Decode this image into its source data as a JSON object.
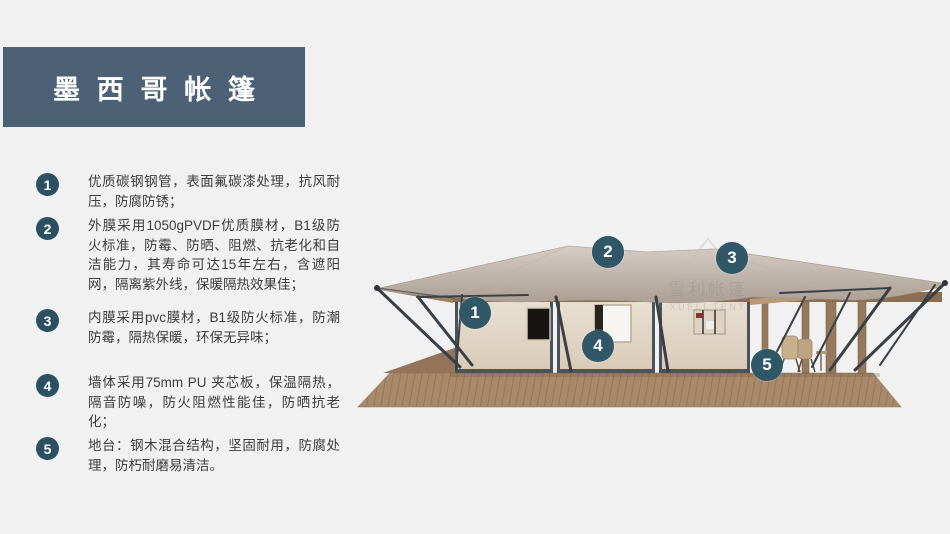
{
  "page": {
    "background": "#f1f1f1"
  },
  "title": {
    "text": "墨西哥帐篷",
    "bg_color": "#4d6176",
    "text_color": "#ffffff"
  },
  "features": [
    {
      "num": "1",
      "text": "优质碳钢钢管，表面氟碳漆处理，抗风耐压，防腐防锈；"
    },
    {
      "num": "2",
      "text": "外膜采用1050gPVDF优质膜材，B1级防火标准，防霉、防晒、阻燃、抗老化和自洁能力，其寿命可达15年左右，含遮阳网，隔离紫外线，保暖隔热效果佳；"
    },
    {
      "num": "3",
      "text": "内膜采用pvc膜材，B1级防火标准，防潮防霉，隔热保暖，环保无异味；"
    },
    {
      "num": "4",
      "text": "墙体采用75mm PU 夹芯板，保温隔热，隔音防噪，防火阻燃性能佳，防晒抗老化；"
    },
    {
      "num": "5",
      "text": "地台：钢木混合结构，坚固耐用，防腐处理，防朽耐磨易清洁。"
    }
  ],
  "diagram": {
    "markers": [
      {
        "num": "1"
      },
      {
        "num": "2"
      },
      {
        "num": "3"
      },
      {
        "num": "4"
      },
      {
        "num": "5"
      }
    ],
    "marker_color": "#2f5767",
    "watermark": {
      "cn": "雪利帐篷",
      "en": "XUELI TENT"
    }
  },
  "colors": {
    "list_badge": "#2a5062",
    "roof_light": "#d3c9c1",
    "roof_dark": "#b2a69b",
    "wall": "#e5dccd",
    "wall_frame": "#485059",
    "deck": "#a8896b",
    "pole": "#3a3f46"
  }
}
